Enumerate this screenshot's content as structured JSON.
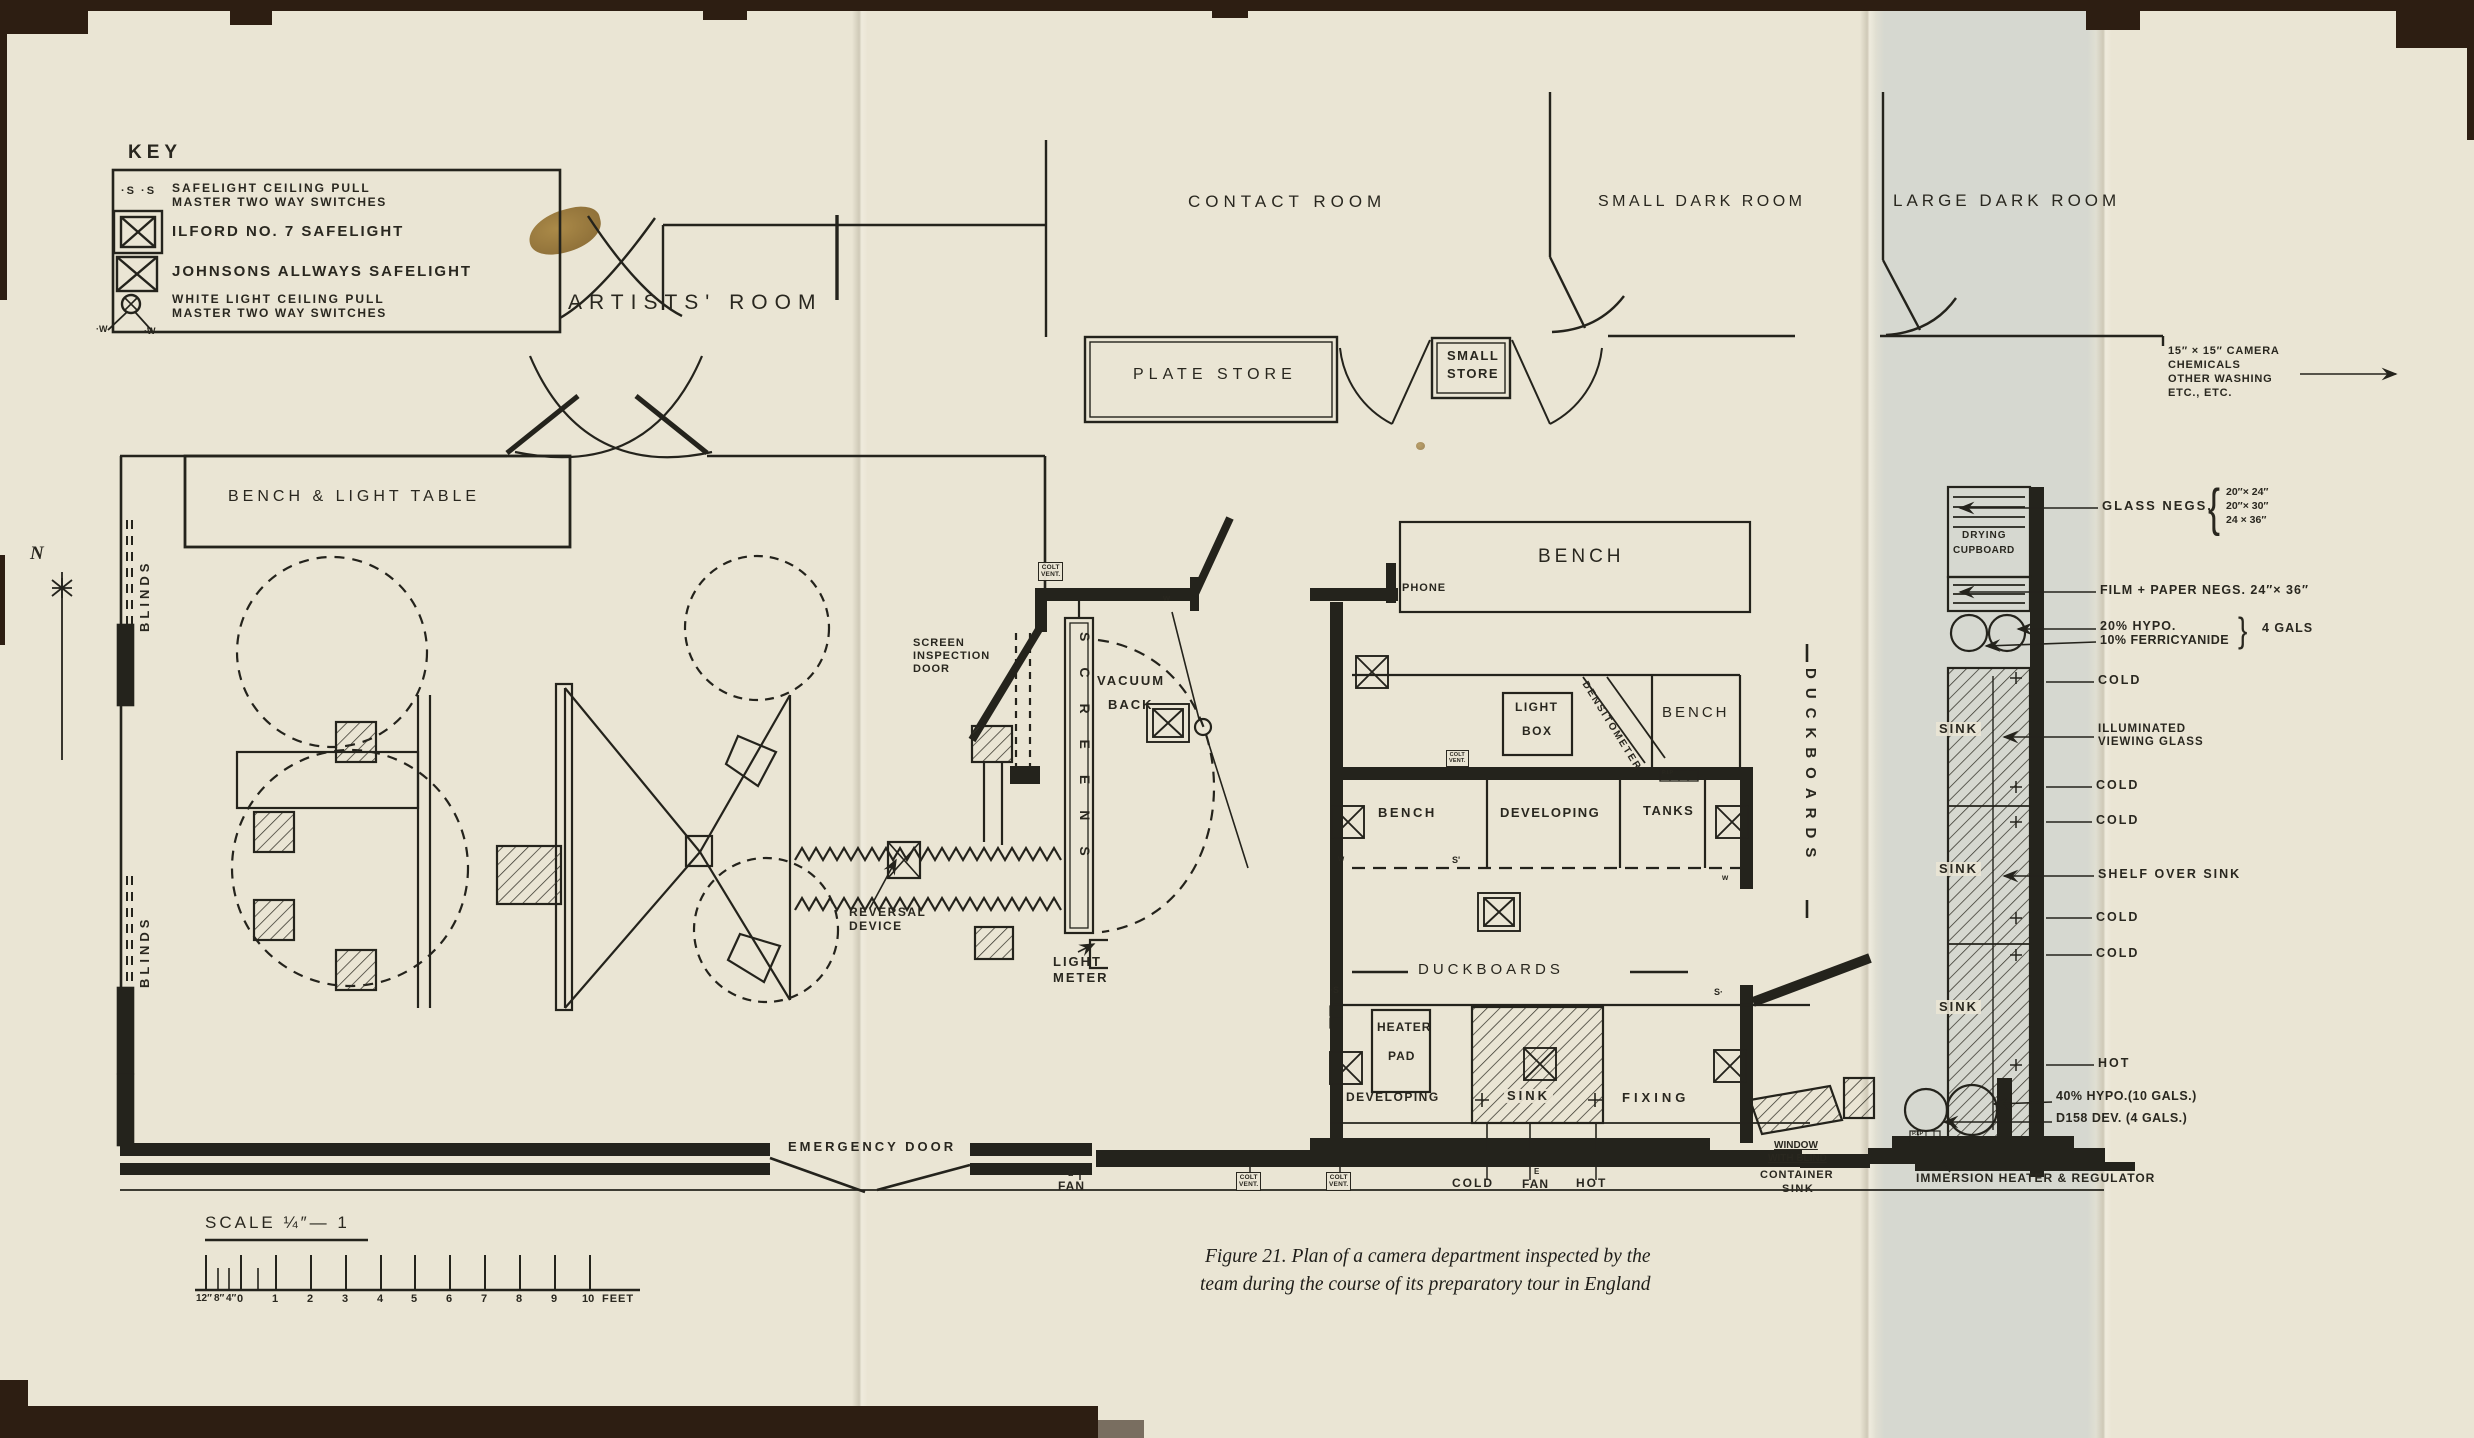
{
  "colors": {
    "paper": "#eae5d4",
    "ink": "#29271f",
    "edge_brown": "#2d1e12",
    "band": "#c4ced1",
    "stain": "#8f6b2f"
  },
  "labels": {
    "key_title": "KEY",
    "key_s": "·S ·S",
    "key_r1a": "SAFELIGHT CEILING PULL",
    "key_r1b": "MASTER TWO WAY SWITCHES",
    "key_r2": "ILFORD NO. 7 SAFELIGHT",
    "key_r3": "JOHNSONS ALLWAYS SAFELIGHT",
    "key_r4a": "WHITE LIGHT CEILING PULL",
    "key_r4b": "MASTER TWO WAY SWITCHES",
    "key_w": "·W",
    "artists_room": "ARTISTS'  ROOM",
    "contact_room": "CONTACT  ROOM",
    "small_dark_room": "SMALL DARK ROOM",
    "large_dark_room": "LARGE  DARK  ROOM",
    "plate_store": "PLATE  STORE",
    "small_store1": "SMALL",
    "small_store2": "STORE",
    "chem1": "15″ × 15″ CAMERA",
    "chem2": "CHEMICALS",
    "chem3": "OTHER  WASHING",
    "chem4": "ETC.,  ETC.",
    "bench_light_table": "BENCH  &  LIGHT  TABLE",
    "blinds": "BLINDS",
    "north": "N",
    "bench": "BENCH",
    "phone": "PHONE",
    "screen1": "SCREEN",
    "screen2": "INSPECTION",
    "screen3": "DOOR",
    "colt": "COLT",
    "vent": "VENT.",
    "screens": "SCREENS",
    "vacuum1": "VACUUM",
    "vacuum2": "BACK",
    "reversal1": "REVERSAL",
    "reversal2": "DEVICE",
    "light": "LIGHT",
    "meter": "METER",
    "box": "BOX",
    "densitometer": "DENSITOMETER",
    "developing": "DEVELOPING",
    "tanks": "TANKS",
    "duckboards": "DUCKBOARDS",
    "heater": "HEATER",
    "pad": "PAD",
    "sink": "SINK",
    "fixing": "FIXING",
    "cold": "COLD",
    "hot": "HOT",
    "fan": "FAN",
    "e": "E",
    "window1": "WINDOW",
    "window2": "WITH BLIND",
    "container": "CONTAINER",
    "immersion": "IMMERSION  HEATER & REGULATOR",
    "drying": "DRYING",
    "cupboard": "CUPBOARD",
    "glass_negs": "GLASS  NEGS.",
    "gn1": "20″× 24″",
    "gn2": "20″× 30″",
    "gn3": "24 × 36″",
    "brace": "{",
    "rbrace": "}",
    "film_paper": "FILM + PAPER  NEGS.  24″× 36″",
    "hypo20": "20% HYPO.",
    "ferri": "10% FERRICYANIDE",
    "gals": "4 GALS",
    "illum1": "ILLUMINATED",
    "illum2": "VIEWING GLASS",
    "shelf": "SHELF  OVER  SINK",
    "hypo40": "40% HYPO.(10 GALS.)",
    "d158": "D158 DEV. (4 GALS.)",
    "emergency": "EMERGENCY  DOOR",
    "sdot": "·S",
    "sdot_r": "S·",
    "sprime": "S'",
    "w": "w",
    "pip": "P.I.P"
  },
  "scale": {
    "title": "SCALE  ¼″— 1",
    "ticks": [
      "12″",
      "8″",
      "4″",
      "0",
      "1",
      "2",
      "3",
      "4",
      "5",
      "6",
      "7",
      "8",
      "9",
      "10",
      "FEET"
    ]
  },
  "caption": {
    "line1": "Figure 21.  Plan of a camera department inspected by the",
    "line2": "team during the course of its preparatory tour in England"
  }
}
